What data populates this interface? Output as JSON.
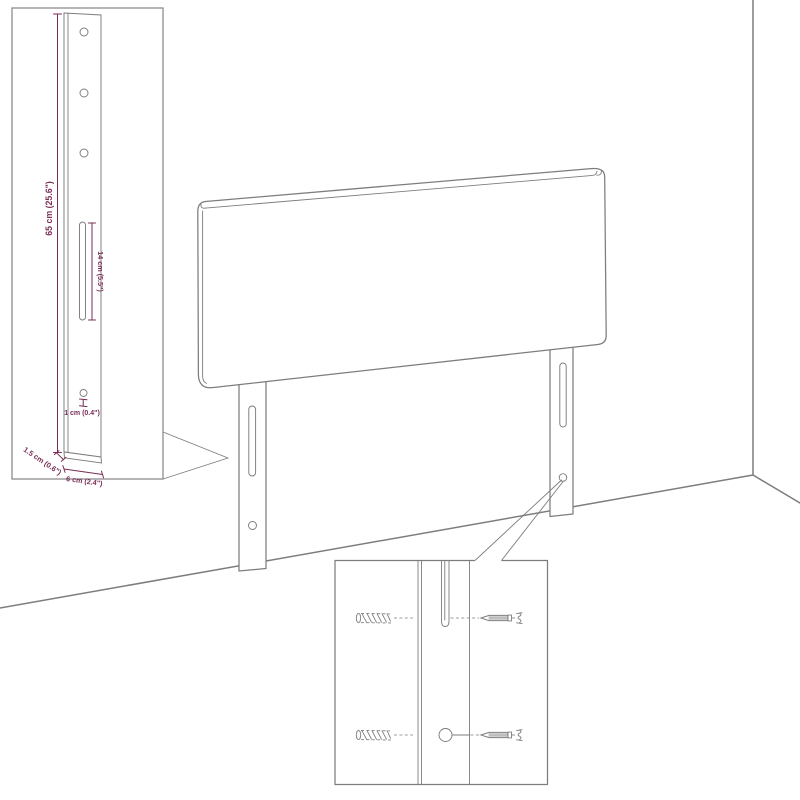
{
  "canvas": {
    "width": 800,
    "height": 800
  },
  "colors": {
    "drawing_line": "#7d7d7d",
    "dimension": "#7a2d56",
    "background": "#ffffff"
  },
  "scene": {
    "description_parts": [
      "headboard-panel",
      "left-mounting-leg",
      "right-mounting-leg",
      "wall-corner",
      "floor-line"
    ]
  },
  "leg_detail_inset": {
    "dimensions": {
      "leg_height": "65 cm (25.6\")",
      "slot_length": "14 cm (5.5\")",
      "hole_diameter": "1 cm (0.4\")",
      "leg_thickness": "1.5 cm (0.6\")",
      "leg_width": "6 cm (2.4\")"
    }
  },
  "mounting_detail_inset": {
    "parts": [
      "wall-anchor",
      "screw",
      "slot",
      "round-hole"
    ]
  }
}
